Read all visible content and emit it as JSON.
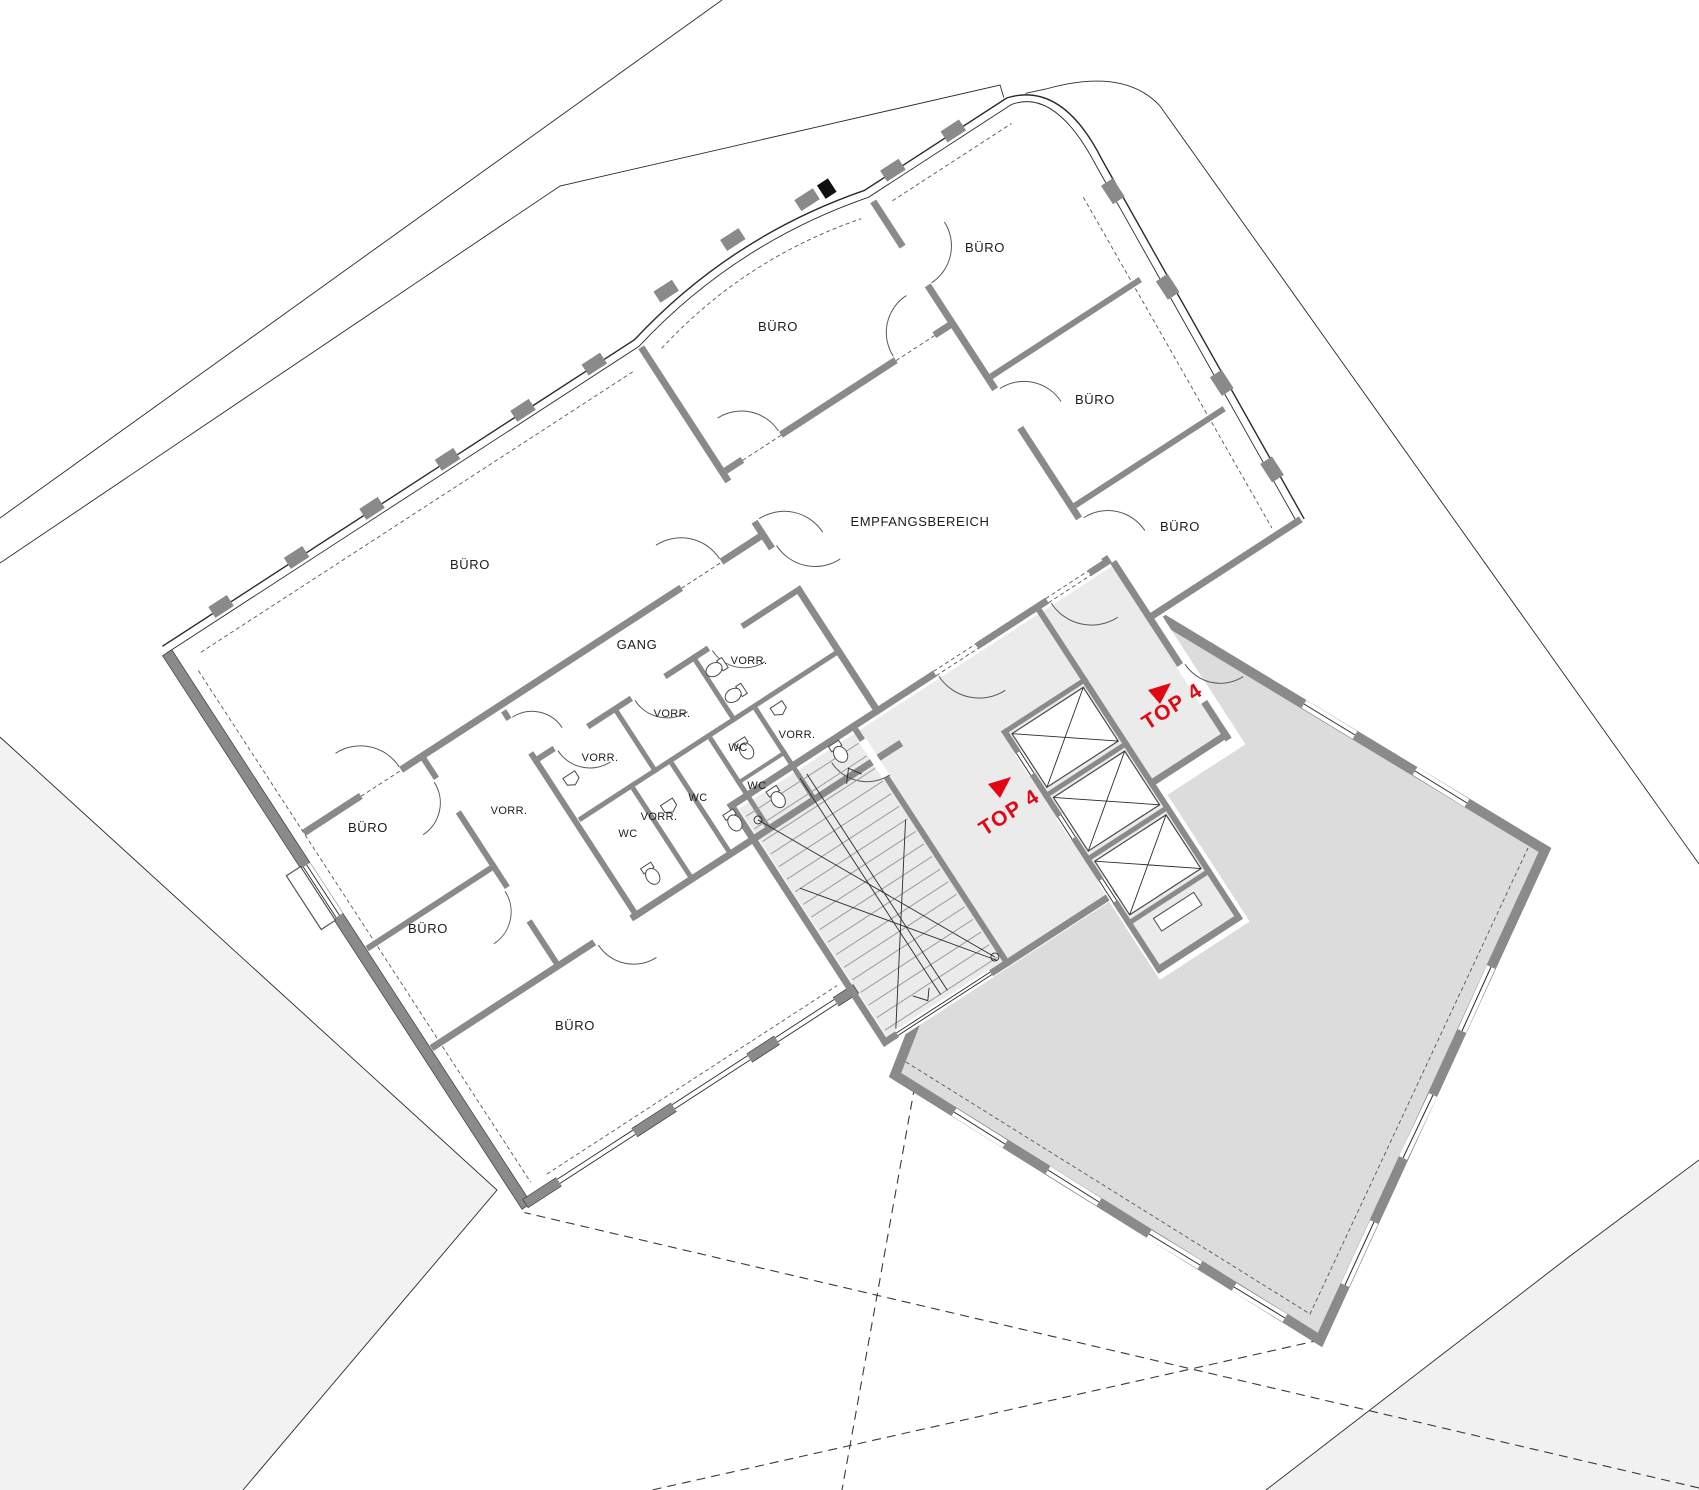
{
  "plan": {
    "colors": {
      "wall_gray": "#8a8a8a",
      "line_black": "#2a2a2a",
      "accent_red": "#e30613",
      "core_floor_fill": "#ebebeb",
      "adjacent_unit_fill": "#dcdcdc",
      "parcel_fill_left": "#f2f2f2",
      "parcel_fill_right": "#f1f1f1"
    },
    "labels": {
      "rooms": [
        {
          "text": "BÜRO"
        },
        {
          "text": "BÜRO"
        },
        {
          "text": "BÜRO"
        },
        {
          "text": "BÜRO"
        },
        {
          "text": "BÜRO"
        },
        {
          "text": "BÜRO"
        },
        {
          "text": "BÜRO"
        },
        {
          "text": "BÜRO"
        },
        {
          "text": "EMPFANGSBEREICH"
        },
        {
          "text": "GANG"
        },
        {
          "text": "VORR."
        },
        {
          "text": "VORR."
        },
        {
          "text": "VORR."
        },
        {
          "text": "VORR."
        },
        {
          "text": "VORR."
        },
        {
          "text": "VORR."
        },
        {
          "text": "WC"
        },
        {
          "text": "WC"
        },
        {
          "text": "WC"
        },
        {
          "text": "WC"
        }
      ],
      "units": [
        {
          "label": "TOP 4"
        },
        {
          "label": "TOP 4"
        }
      ]
    }
  }
}
